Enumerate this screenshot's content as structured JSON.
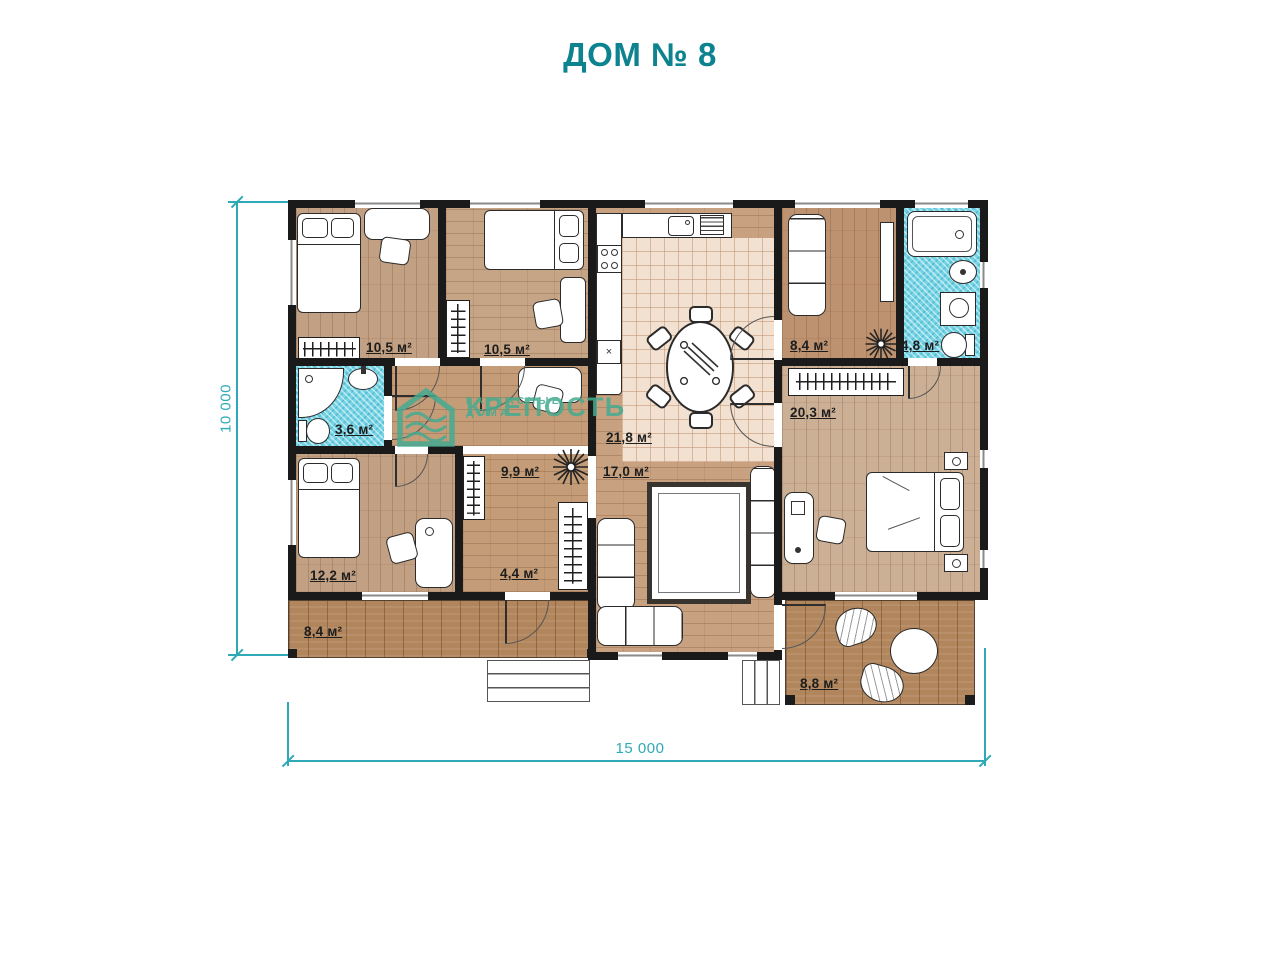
{
  "title": "ДОМ № 8",
  "watermark": {
    "brand": "КРЕПОСТЬ",
    "tagline": "КАРКАСНЫЕ ДОМА"
  },
  "dimensions": {
    "horizontal": "15 000",
    "vertical": "10 000"
  },
  "rooms": {
    "bedroom_top_left": {
      "area": "10,5 м²"
    },
    "bedroom_top_middle": {
      "area": "10,5 м²"
    },
    "kitchen_dining": {
      "area": "21,8 м²"
    },
    "living_room": {
      "area": "17,0 м²"
    },
    "office": {
      "area": "8,4 м²"
    },
    "bathroom_ensuite": {
      "area": "4,8 м²"
    },
    "bedroom_master": {
      "area": "20,3 м²"
    },
    "bathroom_small": {
      "area": "3,6 м²"
    },
    "hallway": {
      "area": "9,9 м²"
    },
    "bedroom_bottom_left": {
      "area": "12,2 м²"
    },
    "entry_hall": {
      "area": "4,4 м²"
    },
    "terrace_left": {
      "area": "8,4 м²"
    },
    "terrace_right": {
      "area": "8,8 м²"
    }
  },
  "colors": {
    "accent_teal": "#0d8390",
    "dimension_teal": "#2fa9b6",
    "logo_green": "#45ab90",
    "wall": "#1a1a1a",
    "wood_floor": "#c5a07f",
    "terrace_wood": "#b2865c",
    "tile_floor": "#f2e0d0",
    "bath_tile_blue": "#74d3e4"
  }
}
